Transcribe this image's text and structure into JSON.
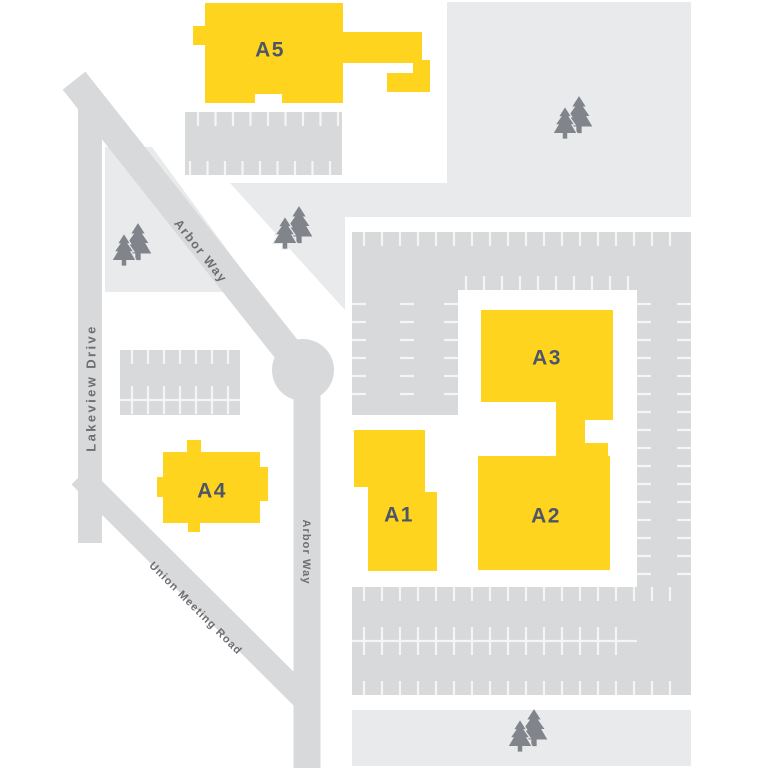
{
  "colors": {
    "background": "#FFFFFF",
    "building": "#FFD41E",
    "building_label": "#4D5668",
    "road": "#D8D9DA",
    "parking": "#D8D9DA",
    "landscape": "#E9EAEB",
    "tick": "#F5F5F6",
    "road_label": "#6D6E71",
    "tree": "#81848A"
  },
  "buildings": [
    {
      "label": "A1"
    },
    {
      "label": "A2"
    },
    {
      "label": "A3"
    },
    {
      "label": "A4"
    },
    {
      "label": "A5"
    }
  ],
  "roads": [
    {
      "name": "Lakeview Drive"
    },
    {
      "name": "Arbor Way"
    },
    {
      "name": "Arbor Way"
    },
    {
      "name": "Union Meeting Road"
    }
  ],
  "features": {
    "tree_cluster_count": 4,
    "parking_lot_count": 4,
    "roundabout_count": 1
  }
}
